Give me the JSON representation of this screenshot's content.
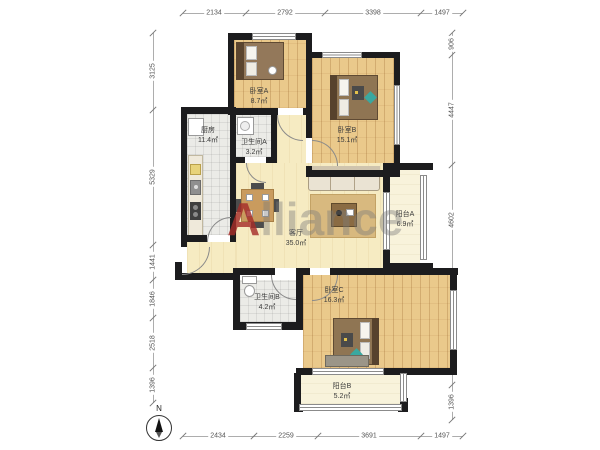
{
  "watermark": {
    "first": "A",
    "rest": "lliance"
  },
  "compass": {
    "label": "N"
  },
  "rooms": {
    "bedroom_a": {
      "name": "卧室A",
      "area": "8.7㎡"
    },
    "bedroom_b": {
      "name": "卧室B",
      "area": "15.1㎡"
    },
    "bedroom_c": {
      "name": "卧室C",
      "area": "16.3㎡"
    },
    "kitchen": {
      "name": "厨房",
      "area": "11.4㎡"
    },
    "bath_a": {
      "name": "卫生间A",
      "area": "3.2㎡"
    },
    "bath_b": {
      "name": "卫生间B",
      "area": "4.2㎡"
    },
    "living": {
      "name": "客厅",
      "area": "35.0㎡"
    },
    "balcony_a": {
      "name": "阳台A",
      "area": "6.9㎡"
    },
    "balcony_b": {
      "name": "阳台B",
      "area": "5.2㎡"
    }
  },
  "dimensions": {
    "top": [
      "2134",
      "2792",
      "3398",
      "1497"
    ],
    "bottom": [
      "2434",
      "2259",
      "3691",
      "1497"
    ],
    "left": [
      "3125",
      "5329",
      "1441",
      "1846",
      "2518",
      "1396"
    ],
    "right": [
      "906",
      "4447",
      "4602",
      "4424",
      "1396"
    ]
  },
  "colors": {
    "wall": "#1c1c1e",
    "wood_floor": "#eac98b",
    "living_floor": "#f6ebc2",
    "tile_floor": "#ebebe7",
    "balcony_floor": "#f8f3db",
    "watermark_red": "#a52d2a",
    "watermark_gray": "#7d7d7d"
  }
}
